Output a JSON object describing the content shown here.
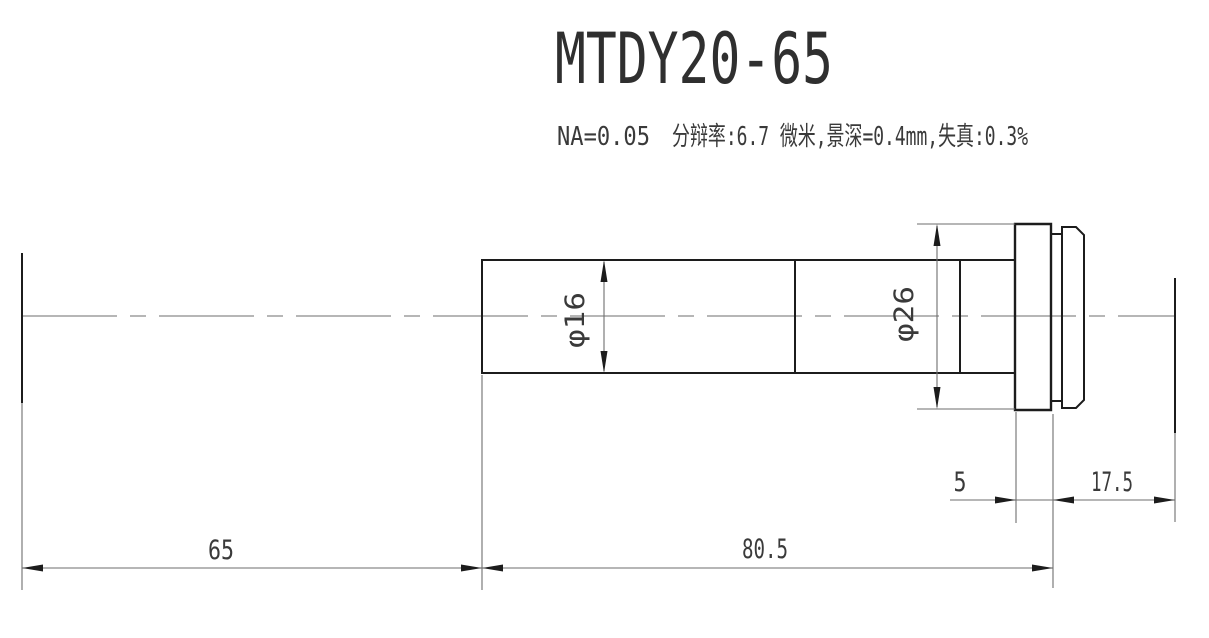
{
  "title": "MTDY20-65",
  "specs": {
    "na": "NA=0.05",
    "details": "分辩率:6.7 微米,景深=0.4mm,失真:0.3%"
  },
  "dimensions": {
    "barrel_diameter": "φ16",
    "flange_diameter": "φ26",
    "flange_width": "5",
    "rear_distance": "17.5",
    "working_distance": "65",
    "body_length": "80.5"
  },
  "colors": {
    "outline": "#1c1c1c",
    "dimension_line": "#6e6e6e",
    "text": "#3a3a3a",
    "background": "#ffffff"
  }
}
